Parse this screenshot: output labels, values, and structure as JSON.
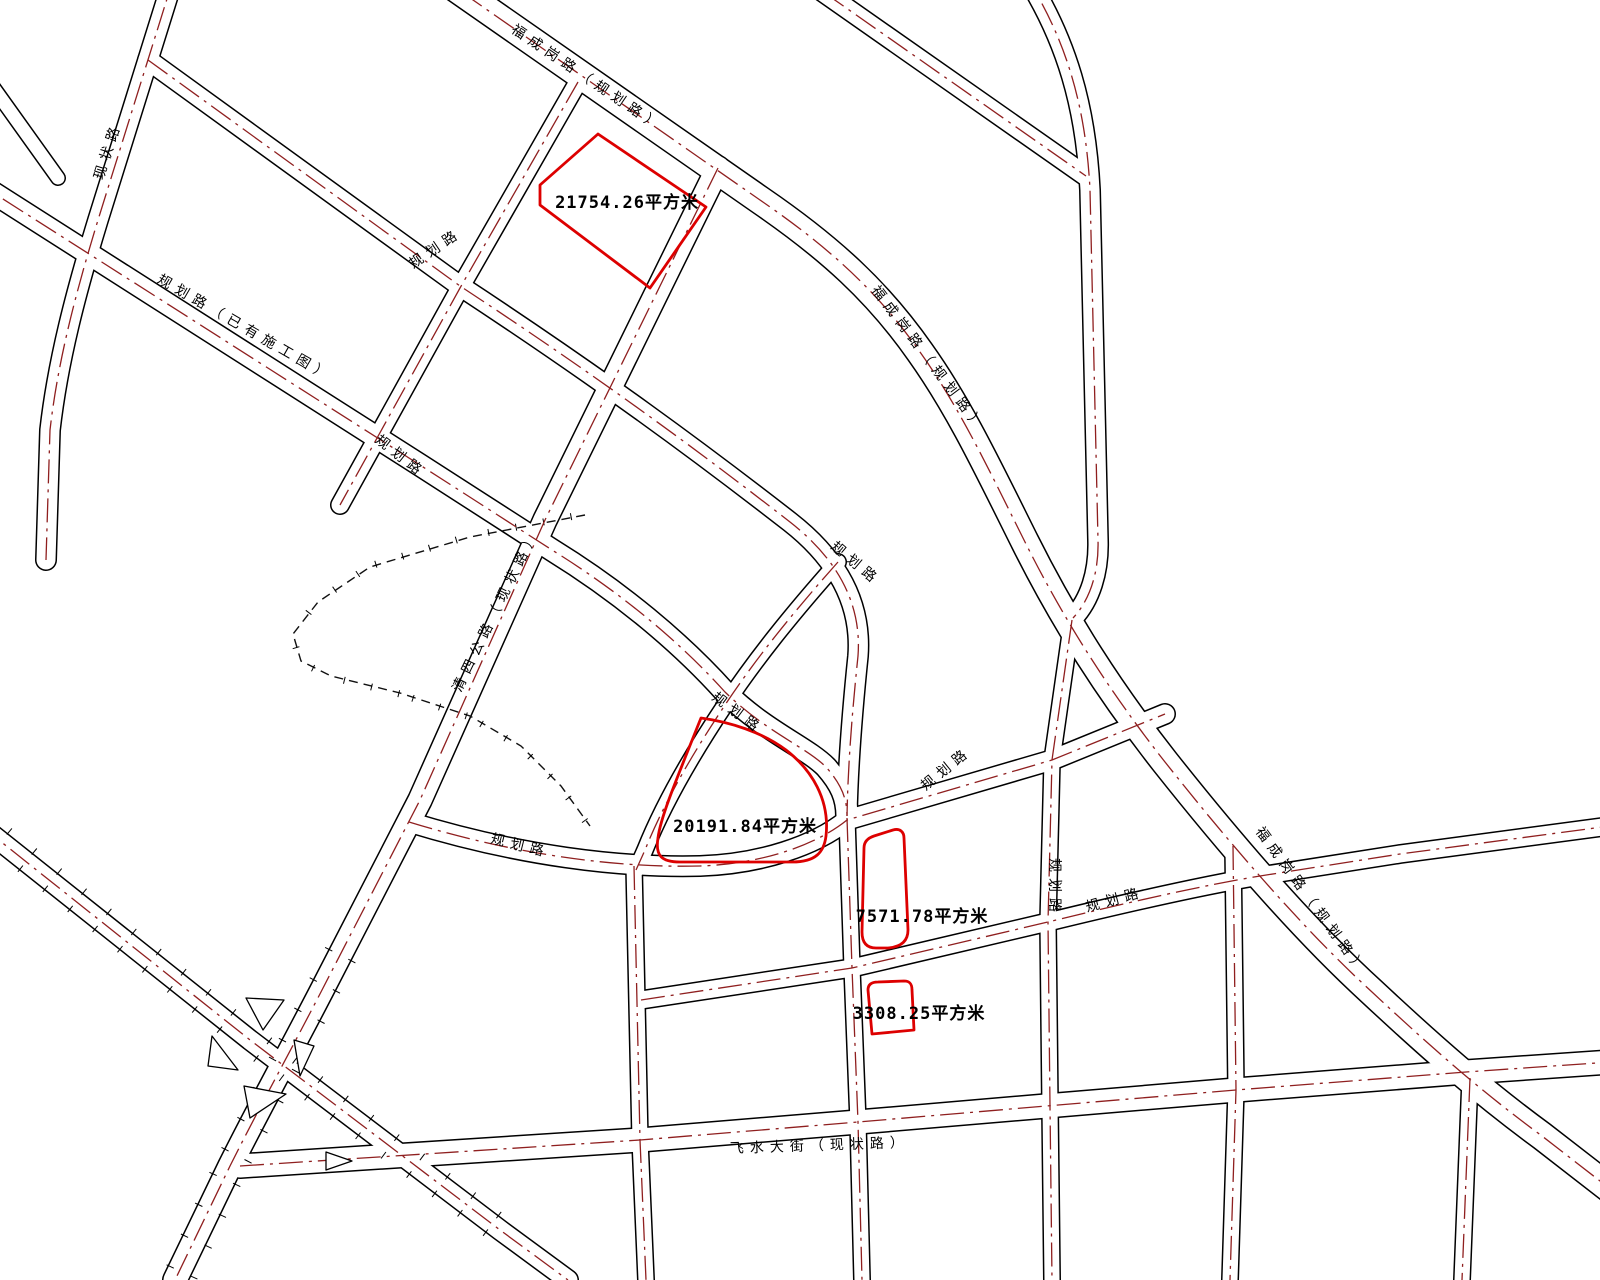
{
  "map": {
    "background_color": "#ffffff",
    "road_outline_color": "#000000",
    "centerline_color": "#8f1f1f",
    "parcel_outline_color": "#dd0000",
    "label_color": "#000000",
    "unit": "平方米"
  },
  "parcels": [
    {
      "area_label": "21754.26平方米",
      "area_value": 21754.26
    },
    {
      "area_label": "20191.84平方米",
      "area_value": 20191.84
    },
    {
      "area_label": "7571.78平方米",
      "area_value": 7571.78
    },
    {
      "area_label": "3308.25平方米",
      "area_value": 3308.25
    }
  ],
  "road_labels": [
    {
      "text": "福成岗路（规划路）"
    },
    {
      "text": "现状路"
    },
    {
      "text": "规划路（已有施工图）"
    },
    {
      "text": "规划路"
    },
    {
      "text": "规划路"
    },
    {
      "text": "清四公路（现状路）"
    },
    {
      "text": "福成岗路（规划路）"
    },
    {
      "text": "规划路"
    },
    {
      "text": "规划路"
    },
    {
      "text": "规划路"
    },
    {
      "text": "规划路"
    },
    {
      "text": "规划路"
    },
    {
      "text": "规划路"
    },
    {
      "text": "福成岗路（规划路）"
    },
    {
      "text": "飞水大街（现状路）"
    }
  ]
}
